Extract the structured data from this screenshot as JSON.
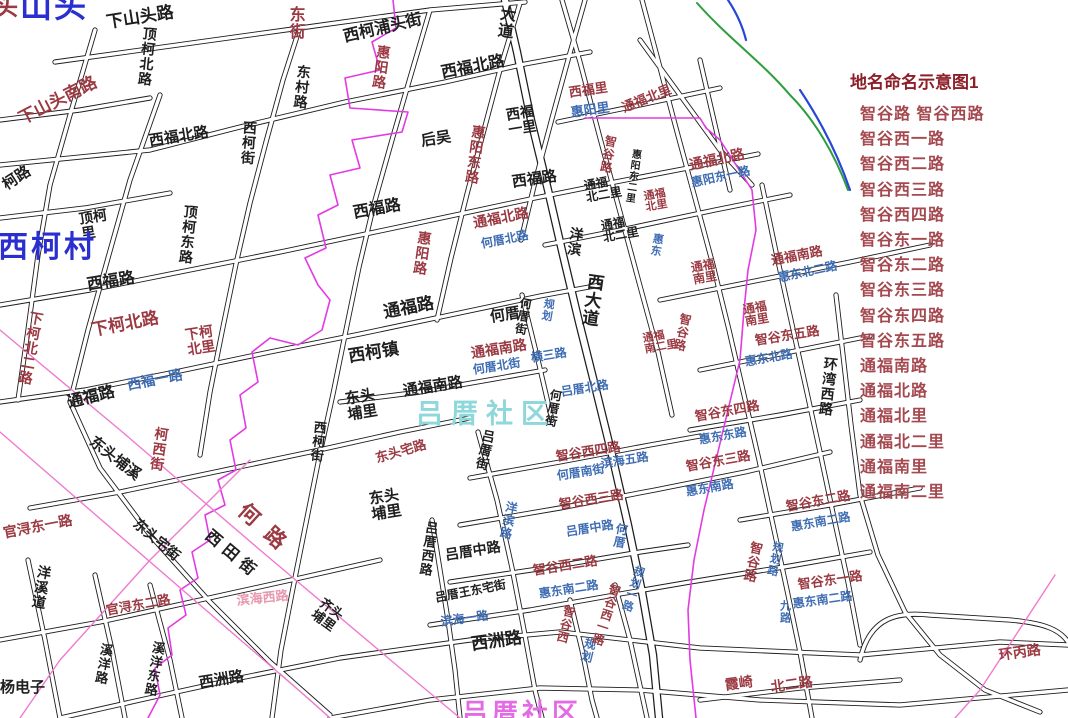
{
  "legend": {
    "title": "地名命名示意图1",
    "items": [
      "智谷路 智谷西路",
      "智谷西一路",
      "智谷西二路",
      "智谷西三路",
      "智谷西四路",
      "智谷东一路",
      "智谷东二路",
      "智谷东三路",
      "智谷东四路",
      "智谷东五路",
      "通福南路",
      "通福北路",
      "通福北里",
      "通福北二里",
      "通福南里",
      "通福南二里"
    ]
  },
  "colors": {
    "red": "#9b3a42",
    "blue": "#3f6db3",
    "black": "#1f1f1f",
    "cyan": "#8ed7da",
    "bigblue": "#2a2fd0",
    "pink": "#e698b0",
    "magenta": "#e36be3",
    "legendTitle": "#8c1f28",
    "legendItem": "#a4494f",
    "roadCasing": "#1c1c1c",
    "boundary": "#e33ae3",
    "plannedLine": "#f07ad0",
    "riverGreen": "#2e9e3c",
    "riverBlue": "#2847d8"
  },
  "map": {
    "community_watermark": "吕厝社区",
    "labels": [
      {
        "t": "头",
        "c": "red",
        "x": -6,
        "y": -4,
        "s": 24
      },
      {
        "t": "山头",
        "c": "bigblue",
        "x": 20,
        "y": -10,
        "s": 32,
        "ls": 2
      },
      {
        "t": "下山头路",
        "c": "black",
        "x": 105,
        "y": 14,
        "s": 17,
        "r": -9
      },
      {
        "t": "顶柯北路",
        "c": "black",
        "x": 143,
        "y": 26,
        "s": 14,
        "v": 1,
        "r": 6
      },
      {
        "t": "西柯浦头街",
        "c": "black",
        "x": 342,
        "y": 30,
        "s": 16,
        "r": -13
      },
      {
        "t": "东街",
        "c": "red",
        "x": 286,
        "y": 6,
        "s": 16,
        "v": 1
      },
      {
        "t": "惠阳路",
        "c": "red",
        "x": 377,
        "y": 44,
        "s": 14,
        "v": 1,
        "r": 8
      },
      {
        "t": "大道",
        "c": "black",
        "x": 498,
        "y": 4,
        "s": 16,
        "v": 1,
        "r": 8
      },
      {
        "t": "东村路",
        "c": "black",
        "x": 297,
        "y": 64,
        "s": 14,
        "v": 1,
        "r": 6
      },
      {
        "t": "西福北路",
        "c": "black",
        "x": 440,
        "y": 66,
        "s": 16,
        "r": -11
      },
      {
        "t": "下山头南路",
        "c": "red",
        "x": 16,
        "y": 112,
        "s": 17,
        "r": -27
      },
      {
        "t": "西福北路",
        "c": "black",
        "x": 148,
        "y": 134,
        "s": 15,
        "r": -9
      },
      {
        "t": "西柯街",
        "c": "black",
        "x": 243,
        "y": 120,
        "s": 14,
        "v": 1,
        "r": 4
      },
      {
        "t": "柯路",
        "c": "black",
        "x": 0,
        "y": 180,
        "s": 15,
        "r": -33
      },
      {
        "t": "后吴",
        "c": "black",
        "x": 420,
        "y": 134,
        "s": 15,
        "r": -9
      },
      {
        "t": "西福\n一里",
        "c": "black",
        "x": 505,
        "y": 108,
        "s": 14,
        "r": -9
      },
      {
        "t": "惠阳东路",
        "c": "red",
        "x": 472,
        "y": 124,
        "s": 14,
        "v": 1,
        "r": 8
      },
      {
        "t": "西福路",
        "c": "black",
        "x": 511,
        "y": 175,
        "s": 15,
        "r": -8
      },
      {
        "t": "西福里",
        "c": "red",
        "x": 568,
        "y": 86,
        "s": 13,
        "r": -8
      },
      {
        "t": "惠阳里",
        "c": "blue",
        "x": 570,
        "y": 106,
        "s": 13,
        "r": -8
      },
      {
        "t": "通福北里",
        "c": "red",
        "x": 620,
        "y": 102,
        "s": 13,
        "r": -22
      },
      {
        "t": "智谷路",
        "c": "red",
        "x": 605,
        "y": 134,
        "s": 12,
        "v": 1,
        "r": 10
      },
      {
        "t": "惠阳东二里",
        "c": "black",
        "x": 630,
        "y": 148,
        "s": 10,
        "v": 1,
        "r": 8
      },
      {
        "t": "通福北路",
        "c": "red",
        "x": 688,
        "y": 158,
        "s": 14,
        "r": -12
      },
      {
        "t": "惠阳东一路",
        "c": "blue",
        "x": 690,
        "y": 177,
        "s": 12,
        "r": -12
      },
      {
        "t": "通福\n北二里",
        "c": "black",
        "x": 583,
        "y": 180,
        "s": 12,
        "r": -10
      },
      {
        "t": "通福\n北二里",
        "c": "black",
        "x": 600,
        "y": 220,
        "s": 12,
        "r": -10
      },
      {
        "t": "通福\n北里",
        "c": "red",
        "x": 643,
        "y": 192,
        "s": 11,
        "r": -10
      },
      {
        "t": "惠东",
        "c": "blue",
        "x": 652,
        "y": 232,
        "s": 11,
        "v": 1,
        "r": 10
      },
      {
        "t": "顶柯\n里",
        "c": "black",
        "x": 78,
        "y": 212,
        "s": 14,
        "r": -9
      },
      {
        "t": "顶柯东路",
        "c": "black",
        "x": 184,
        "y": 204,
        "s": 14,
        "v": 1,
        "r": 6
      },
      {
        "t": "西柯村",
        "c": "bigblue",
        "x": -2,
        "y": 232,
        "s": 30,
        "ls": 3
      },
      {
        "t": "西福路",
        "c": "black",
        "x": 86,
        "y": 278,
        "s": 16,
        "r": -9
      },
      {
        "t": "下柯北二路",
        "c": "red",
        "x": 30,
        "y": 310,
        "s": 14,
        "v": 1,
        "r": 10
      },
      {
        "t": "下柯北路",
        "c": "red",
        "x": 90,
        "y": 322,
        "s": 17,
        "r": -11
      },
      {
        "t": "下柯\n北里",
        "c": "red",
        "x": 184,
        "y": 328,
        "s": 14,
        "r": -9
      },
      {
        "t": "通福路",
        "c": "black",
        "x": 66,
        "y": 396,
        "s": 16,
        "r": -14
      },
      {
        "t": "西福一路",
        "c": "blue",
        "x": 126,
        "y": 378,
        "s": 14,
        "r": -11
      },
      {
        "t": "西福路",
        "c": "black",
        "x": 352,
        "y": 206,
        "s": 16,
        "r": -10
      },
      {
        "t": "惠阳路",
        "c": "red",
        "x": 418,
        "y": 230,
        "s": 14,
        "v": 1,
        "r": 8
      },
      {
        "t": "通福北路",
        "c": "red",
        "x": 472,
        "y": 216,
        "s": 14,
        "r": -11
      },
      {
        "t": "何厝北路",
        "c": "blue",
        "x": 480,
        "y": 238,
        "s": 12,
        "r": -11
      },
      {
        "t": "洋滨",
        "c": "black",
        "x": 570,
        "y": 226,
        "s": 14,
        "v": 1,
        "r": 8
      },
      {
        "t": "西大道",
        "c": "black",
        "x": 586,
        "y": 272,
        "s": 17,
        "v": 1,
        "r": 8
      },
      {
        "t": "通福路",
        "c": "black",
        "x": 382,
        "y": 304,
        "s": 17,
        "r": -11
      },
      {
        "t": "何厝",
        "c": "black",
        "x": 489,
        "y": 310,
        "s": 15,
        "r": -9
      },
      {
        "t": "何厝街",
        "c": "black",
        "x": 520,
        "y": 296,
        "s": 12,
        "v": 1,
        "r": 10
      },
      {
        "t": "规划",
        "c": "blue",
        "x": 543,
        "y": 297,
        "s": 11,
        "v": 1,
        "r": 10
      },
      {
        "t": "西柯镇",
        "c": "black",
        "x": 347,
        "y": 348,
        "s": 17,
        "r": -9
      },
      {
        "t": "通福南路",
        "c": "red",
        "x": 470,
        "y": 346,
        "s": 14,
        "r": -9
      },
      {
        "t": "何厝北街",
        "c": "blue",
        "x": 472,
        "y": 364,
        "s": 12,
        "r": -9
      },
      {
        "t": "横三路",
        "c": "blue",
        "x": 530,
        "y": 352,
        "s": 12,
        "r": -9
      },
      {
        "t": "吕厝北路",
        "c": "blue",
        "x": 560,
        "y": 386,
        "s": 12,
        "r": -9
      },
      {
        "t": "何厝街",
        "c": "black",
        "x": 550,
        "y": 388,
        "s": 12,
        "v": 1,
        "r": 10
      },
      {
        "t": "东头\n埔里",
        "c": "black",
        "x": 344,
        "y": 392,
        "s": 15,
        "r": -9
      },
      {
        "t": "通福南路",
        "c": "black",
        "x": 402,
        "y": 384,
        "s": 15,
        "r": -9
      },
      {
        "t": "吕厝社区",
        "c": "cyan",
        "x": 416,
        "y": 400,
        "s": 27,
        "ls": 8
      },
      {
        "t": "东头宅路",
        "c": "red",
        "x": 374,
        "y": 452,
        "s": 13,
        "r": -16
      },
      {
        "t": "吕厝街",
        "c": "black",
        "x": 482,
        "y": 428,
        "s": 13,
        "v": 1,
        "r": 12
      },
      {
        "t": "洋滨路",
        "c": "blue",
        "x": 506,
        "y": 500,
        "s": 12,
        "v": 1,
        "r": 12
      },
      {
        "t": "东头\n埔里",
        "c": "black",
        "x": 368,
        "y": 492,
        "s": 15,
        "r": -9
      },
      {
        "t": "西柯街",
        "c": "black",
        "x": 313,
        "y": 420,
        "s": 13,
        "v": 1,
        "r": 6
      },
      {
        "t": "柯西街",
        "c": "red",
        "x": 155,
        "y": 426,
        "s": 14,
        "v": 1,
        "r": 8
      },
      {
        "t": "东头埔溪",
        "c": "black",
        "x": 96,
        "y": 434,
        "s": 15,
        "r": 38
      },
      {
        "t": "东头宅街",
        "c": "black",
        "x": 140,
        "y": 516,
        "s": 14,
        "r": 40
      },
      {
        "t": "官浔东一路",
        "c": "red",
        "x": 2,
        "y": 526,
        "s": 14,
        "r": -11
      },
      {
        "t": "官浔东二路",
        "c": "red",
        "x": 105,
        "y": 604,
        "s": 13,
        "r": -10
      },
      {
        "t": "何路",
        "c": "red",
        "x": 248,
        "y": 500,
        "s": 21,
        "r": 42,
        "ls": 14
      },
      {
        "t": "西田街",
        "c": "black",
        "x": 212,
        "y": 528,
        "s": 16,
        "r": 40,
        "ls": 6
      },
      {
        "t": "滨海西路",
        "c": "pink",
        "x": 236,
        "y": 594,
        "s": 13,
        "r": -6
      },
      {
        "t": "齐头\n埔里",
        "c": "black",
        "x": 325,
        "y": 596,
        "s": 13,
        "r": 36
      },
      {
        "t": "洋溪道",
        "c": "black",
        "x": 38,
        "y": 564,
        "s": 14,
        "v": 1,
        "r": 10
      },
      {
        "t": "溪洋路",
        "c": "black",
        "x": 100,
        "y": 642,
        "s": 13,
        "v": 1,
        "r": 10
      },
      {
        "t": "溪洋东路",
        "c": "black",
        "x": 152,
        "y": 640,
        "s": 13,
        "v": 1,
        "r": 10
      },
      {
        "t": "杨电子",
        "c": "black",
        "x": 0,
        "y": 680,
        "s": 15
      },
      {
        "t": "西洲路",
        "c": "black",
        "x": 198,
        "y": 676,
        "s": 15,
        "r": -9
      },
      {
        "t": "西洲路",
        "c": "black",
        "x": 470,
        "y": 636,
        "s": 17,
        "r": -8
      },
      {
        "t": "吕厝西路",
        "c": "black",
        "x": 425,
        "y": 520,
        "s": 13,
        "v": 1,
        "r": 8
      },
      {
        "t": "吕厝中路",
        "c": "black",
        "x": 444,
        "y": 548,
        "s": 14,
        "r": -9
      },
      {
        "t": "吕厝王东宅街",
        "c": "black",
        "x": 434,
        "y": 592,
        "s": 12,
        "r": -11
      },
      {
        "t": "滨海一路",
        "c": "blue",
        "x": 440,
        "y": 616,
        "s": 12,
        "r": -8
      },
      {
        "t": "智谷西二路",
        "c": "red",
        "x": 532,
        "y": 564,
        "s": 13,
        "r": -9
      },
      {
        "t": "惠东南二路",
        "c": "blue",
        "x": 538,
        "y": 588,
        "s": 12,
        "r": -9
      },
      {
        "t": "智谷西三路",
        "c": "red",
        "x": 558,
        "y": 498,
        "s": 13,
        "r": -9
      },
      {
        "t": "吕厝中路",
        "c": "blue",
        "x": 565,
        "y": 526,
        "s": 12,
        "r": -9
      },
      {
        "t": "智谷西四路",
        "c": "red",
        "x": 555,
        "y": 450,
        "s": 13,
        "r": -9
      },
      {
        "t": "何厝南街",
        "c": "blue",
        "x": 556,
        "y": 470,
        "s": 12,
        "r": -9
      },
      {
        "t": "滨海五路",
        "c": "blue",
        "x": 600,
        "y": 458,
        "s": 12,
        "r": -9
      },
      {
        "t": "何厝",
        "c": "blue",
        "x": 616,
        "y": 522,
        "s": 12,
        "v": 1,
        "r": 10
      },
      {
        "t": "智谷西",
        "c": "red",
        "x": 564,
        "y": 604,
        "s": 12,
        "v": 1,
        "r": 14
      },
      {
        "t": "规划",
        "c": "blue",
        "x": 585,
        "y": 636,
        "s": 12,
        "v": 1,
        "r": 14
      },
      {
        "t": "智谷西一路",
        "c": "red",
        "x": 610,
        "y": 582,
        "s": 12,
        "v": 1,
        "r": 18
      },
      {
        "t": "规划一路",
        "c": "blue",
        "x": 634,
        "y": 564,
        "s": 11,
        "v": 1,
        "r": 18
      },
      {
        "t": "智谷东四路",
        "c": "red",
        "x": 694,
        "y": 410,
        "s": 13,
        "r": -10
      },
      {
        "t": "惠东东路",
        "c": "blue",
        "x": 698,
        "y": 434,
        "s": 12,
        "r": -10
      },
      {
        "t": "智谷东三路",
        "c": "red",
        "x": 685,
        "y": 460,
        "s": 13,
        "r": -10
      },
      {
        "t": "惠东南路",
        "c": "blue",
        "x": 685,
        "y": 486,
        "s": 12,
        "r": -10
      },
      {
        "t": "智谷东二路",
        "c": "red",
        "x": 785,
        "y": 500,
        "s": 13,
        "r": -10
      },
      {
        "t": "惠东南二路",
        "c": "blue",
        "x": 790,
        "y": 521,
        "s": 12,
        "r": -10
      },
      {
        "t": "智谷路",
        "c": "red",
        "x": 750,
        "y": 540,
        "s": 13,
        "v": 1,
        "r": 12
      },
      {
        "t": "规划路",
        "c": "blue",
        "x": 772,
        "y": 540,
        "s": 11,
        "v": 1,
        "r": 12
      },
      {
        "t": "智谷东一路",
        "c": "red",
        "x": 797,
        "y": 578,
        "s": 13,
        "r": -8
      },
      {
        "t": "惠东南二路",
        "c": "blue",
        "x": 792,
        "y": 598,
        "s": 12,
        "r": -8
      },
      {
        "t": "九路",
        "c": "blue",
        "x": 778,
        "y": 600,
        "s": 11,
        "v": 1
      },
      {
        "t": "霞崎",
        "c": "red",
        "x": 724,
        "y": 678,
        "s": 14,
        "r": -8
      },
      {
        "t": "北二路",
        "c": "red",
        "x": 770,
        "y": 680,
        "s": 14,
        "r": -8
      },
      {
        "t": "环丙路",
        "c": "red",
        "x": 998,
        "y": 648,
        "s": 14,
        "r": -8
      },
      {
        "t": "环湾西路",
        "c": "black",
        "x": 824,
        "y": 356,
        "s": 14,
        "v": 1,
        "r": 6
      },
      {
        "t": "通福南路",
        "c": "red",
        "x": 770,
        "y": 254,
        "s": 13,
        "r": -11
      },
      {
        "t": "惠东北二路",
        "c": "blue",
        "x": 777,
        "y": 272,
        "s": 12,
        "r": -12
      },
      {
        "t": "智谷东五路",
        "c": "red",
        "x": 754,
        "y": 334,
        "s": 13,
        "r": -9
      },
      {
        "t": "惠东北路",
        "c": "blue",
        "x": 744,
        "y": 356,
        "s": 12,
        "r": -10
      },
      {
        "t": "通福\n南里",
        "c": "red",
        "x": 690,
        "y": 262,
        "s": 12,
        "r": -10
      },
      {
        "t": "通福\n南里",
        "c": "red",
        "x": 742,
        "y": 304,
        "s": 12,
        "r": -10
      },
      {
        "t": "智谷路",
        "c": "red",
        "x": 680,
        "y": 312,
        "s": 12,
        "v": 1,
        "r": 12
      },
      {
        "t": "通福\n南二里",
        "c": "red",
        "x": 642,
        "y": 334,
        "s": 11,
        "r": -10
      },
      {
        "t": "吕厝社区",
        "c": "magenta",
        "x": 462,
        "y": 700,
        "s": 26,
        "ls": 4
      }
    ]
  }
}
